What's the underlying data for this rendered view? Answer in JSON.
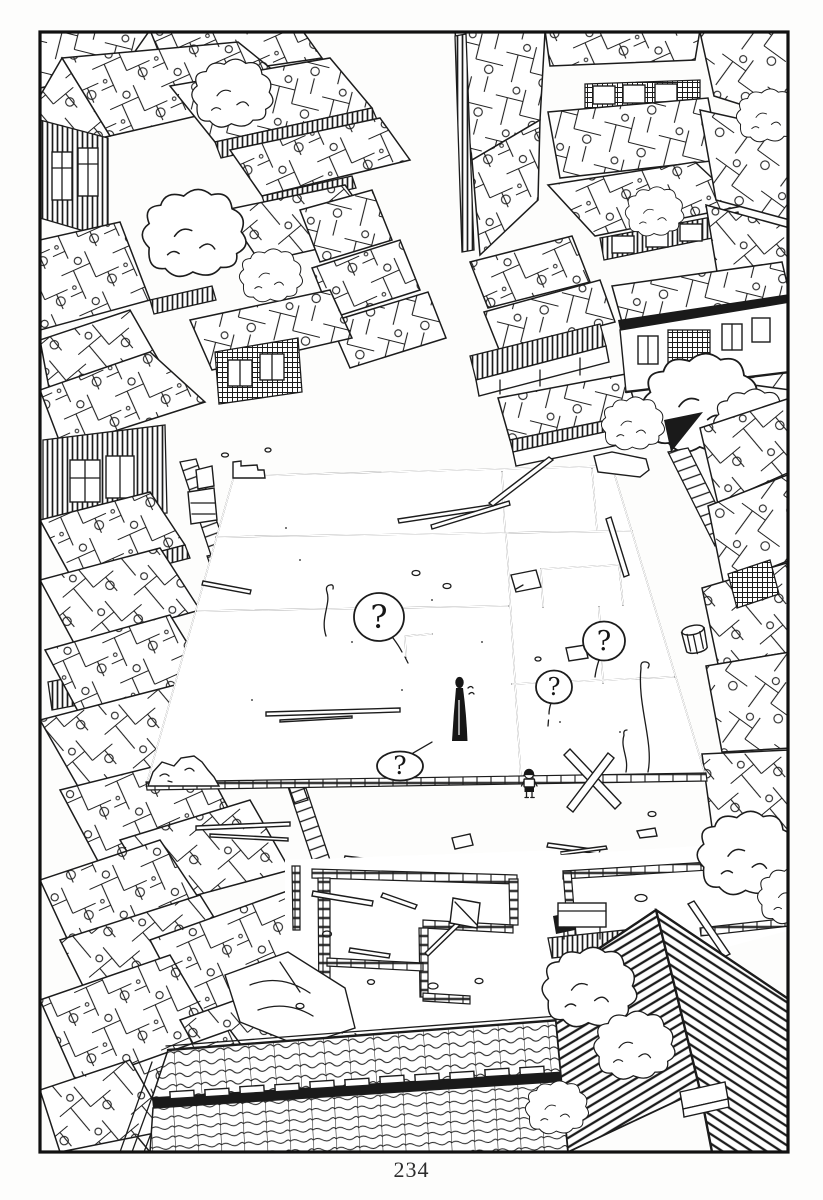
{
  "page": {
    "number": "234"
  },
  "panel": {
    "balloons": [
      {
        "text": "?"
      },
      {
        "text": "?"
      },
      {
        "text": "?"
      },
      {
        "text": "?"
      }
    ]
  },
  "colors": {
    "ink": "#1c1c1c",
    "paper": "#ffffff"
  }
}
